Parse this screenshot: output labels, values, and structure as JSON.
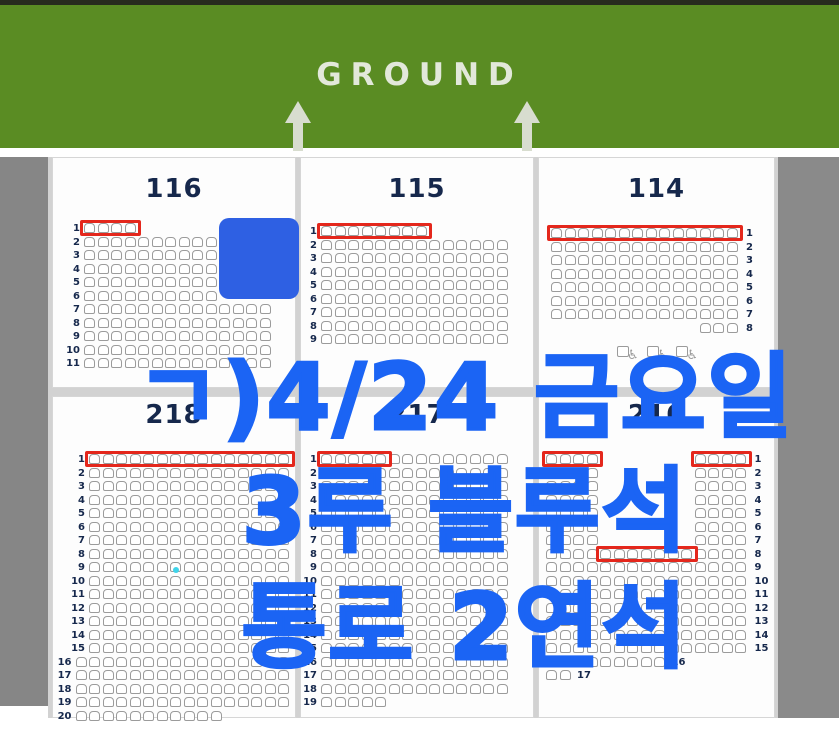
{
  "banner": {
    "label": "GROUND",
    "bg_color": "#5a8c23",
    "text_color": "#e2e8da",
    "arrow_count": 2
  },
  "overlay": {
    "color": "#1b64f4",
    "lines": [
      "ㄱ)4/24 금요일",
      "3루 블루석",
      "통로 2연석"
    ]
  },
  "colors": {
    "seat_border": "#9b9b9b",
    "highlight_red": "#e4271c",
    "blocked_blue": "#2e60e3",
    "section_text": "#16284c",
    "cyan_marker": "#3fd4ea"
  },
  "sections": [
    {
      "id": "116",
      "label": "116",
      "numbers": "left",
      "cols": 14,
      "panel": {
        "x": 52,
        "y": 157,
        "w": 244,
        "h": 231
      },
      "grid": {
        "ox": 31,
        "oy": 65
      },
      "rows": [
        {
          "n": 1,
          "segs": [
            [
              0,
              4
            ]
          ],
          "red": [
            [
              0,
              4
            ]
          ]
        },
        {
          "from": 2,
          "to": 6,
          "segs": [
            [
              0,
              10
            ]
          ]
        },
        {
          "from": 7,
          "to": 11,
          "segs": [
            [
              0,
              14
            ]
          ]
        }
      ],
      "blue_square": {
        "x": 166,
        "y": 60,
        "w": 80,
        "h": 81
      }
    },
    {
      "id": "115",
      "label": "115",
      "numbers": "left",
      "cols": 14,
      "panel": {
        "x": 300,
        "y": 157,
        "w": 234,
        "h": 231
      },
      "grid": {
        "ox": 20,
        "oy": 68
      },
      "rows": [
        {
          "n": 1,
          "segs": [
            [
              0,
              8
            ]
          ],
          "red": [
            [
              0,
              8
            ]
          ]
        },
        {
          "from": 2,
          "to": 9,
          "segs": [
            [
              0,
              14
            ]
          ]
        }
      ]
    },
    {
      "id": "114",
      "label": "114",
      "numbers": "right",
      "cols": 14,
      "panel": {
        "x": 538,
        "y": 157,
        "w": 237,
        "h": 231
      },
      "grid": {
        "ox": 12,
        "oy": 70
      },
      "rows": [
        {
          "n": 1,
          "segs": [
            [
              0,
              14
            ]
          ],
          "red": [
            [
              0,
              14
            ]
          ]
        },
        {
          "from": 2,
          "to": 7,
          "segs": [
            [
              0,
              14
            ]
          ]
        },
        {
          "n": 8,
          "segs": [
            [
              11,
              3
            ]
          ]
        }
      ],
      "wheelchair": {
        "x": 78,
        "y": 188,
        "count": 3
      }
    },
    {
      "id": "218",
      "label": "218",
      "numbers": "left",
      "cols": 15,
      "panel": {
        "x": 52,
        "y": 396,
        "w": 244,
        "h": 322
      },
      "grid": {
        "ox": 36,
        "oy": 57
      },
      "rows": [
        {
          "n": 1,
          "segs": [
            [
              0,
              15
            ]
          ],
          "red": [
            [
              0,
              15
            ]
          ]
        },
        {
          "from": 2,
          "to": 15,
          "segs": [
            [
              0,
              15
            ]
          ]
        },
        {
          "from": 16,
          "to": 19,
          "segs": [
            [
              -1,
              16
            ]
          ]
        },
        {
          "n": 20,
          "segs": [
            [
              -1,
              11
            ]
          ]
        }
      ],
      "dot": {
        "x": 120,
        "y": 170
      }
    },
    {
      "id": "217",
      "label": "217",
      "numbers": "left",
      "cols": 14,
      "panel": {
        "x": 300,
        "y": 396,
        "w": 234,
        "h": 322
      },
      "grid": {
        "ox": 20,
        "oy": 57
      },
      "rows": [
        {
          "n": 1,
          "segs": [
            [
              0,
              14
            ]
          ],
          "red": [
            [
              0,
              5
            ]
          ]
        },
        {
          "from": 2,
          "to": 18,
          "segs": [
            [
              0,
              14
            ]
          ]
        },
        {
          "n": 19,
          "segs": [
            [
              0,
              5
            ]
          ]
        }
      ]
    },
    {
      "id": "216",
      "label": "216",
      "numbers": "right",
      "cols": 15,
      "panel": {
        "x": 538,
        "y": 396,
        "w": 237,
        "h": 322
      },
      "grid": {
        "ox": 7,
        "oy": 57
      },
      "rows": [
        {
          "n": 1,
          "segs": [
            [
              0,
              4
            ],
            [
              11,
              4
            ]
          ],
          "red": [
            [
              0,
              4
            ],
            [
              11,
              4
            ]
          ]
        },
        {
          "from": 2,
          "to": 7,
          "segs": [
            [
              0,
              4
            ],
            [
              11,
              4
            ]
          ]
        },
        {
          "n": 8,
          "segs": [
            [
              0,
              15
            ]
          ],
          "red": [
            [
              4,
              7
            ]
          ]
        },
        {
          "from": 9,
          "to": 15,
          "segs": [
            [
              0,
              15
            ]
          ]
        },
        {
          "n": 16,
          "segs": [
            [
              0,
              9
            ]
          ],
          "inline": true
        },
        {
          "n": 17,
          "segs": [
            [
              0,
              2
            ]
          ],
          "inline": true
        }
      ]
    }
  ]
}
